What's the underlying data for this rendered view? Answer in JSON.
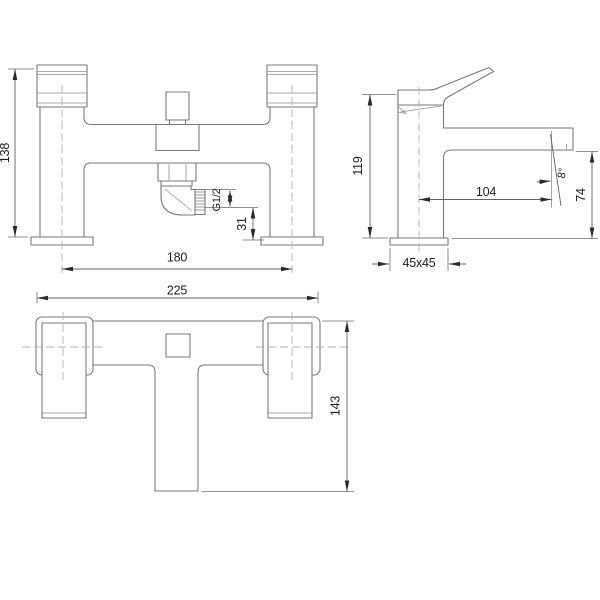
{
  "title": "Bath shower mixer and basin tap technical dimension drawing",
  "colors": {
    "background": "#ffffff",
    "line": "#7a7a7a",
    "dimension_line": "#636363",
    "text": "#1d1d1d",
    "centerline": "#b3b3b3"
  },
  "views": {
    "front": {
      "height": "138",
      "centres": "180",
      "thread": "G1/2",
      "outlet_offset": "31"
    },
    "side": {
      "height": "119",
      "reach": "104",
      "spout_height": "74",
      "base": "45x45",
      "angle": "8°"
    },
    "plan": {
      "width": "225",
      "depth": "143"
    }
  }
}
